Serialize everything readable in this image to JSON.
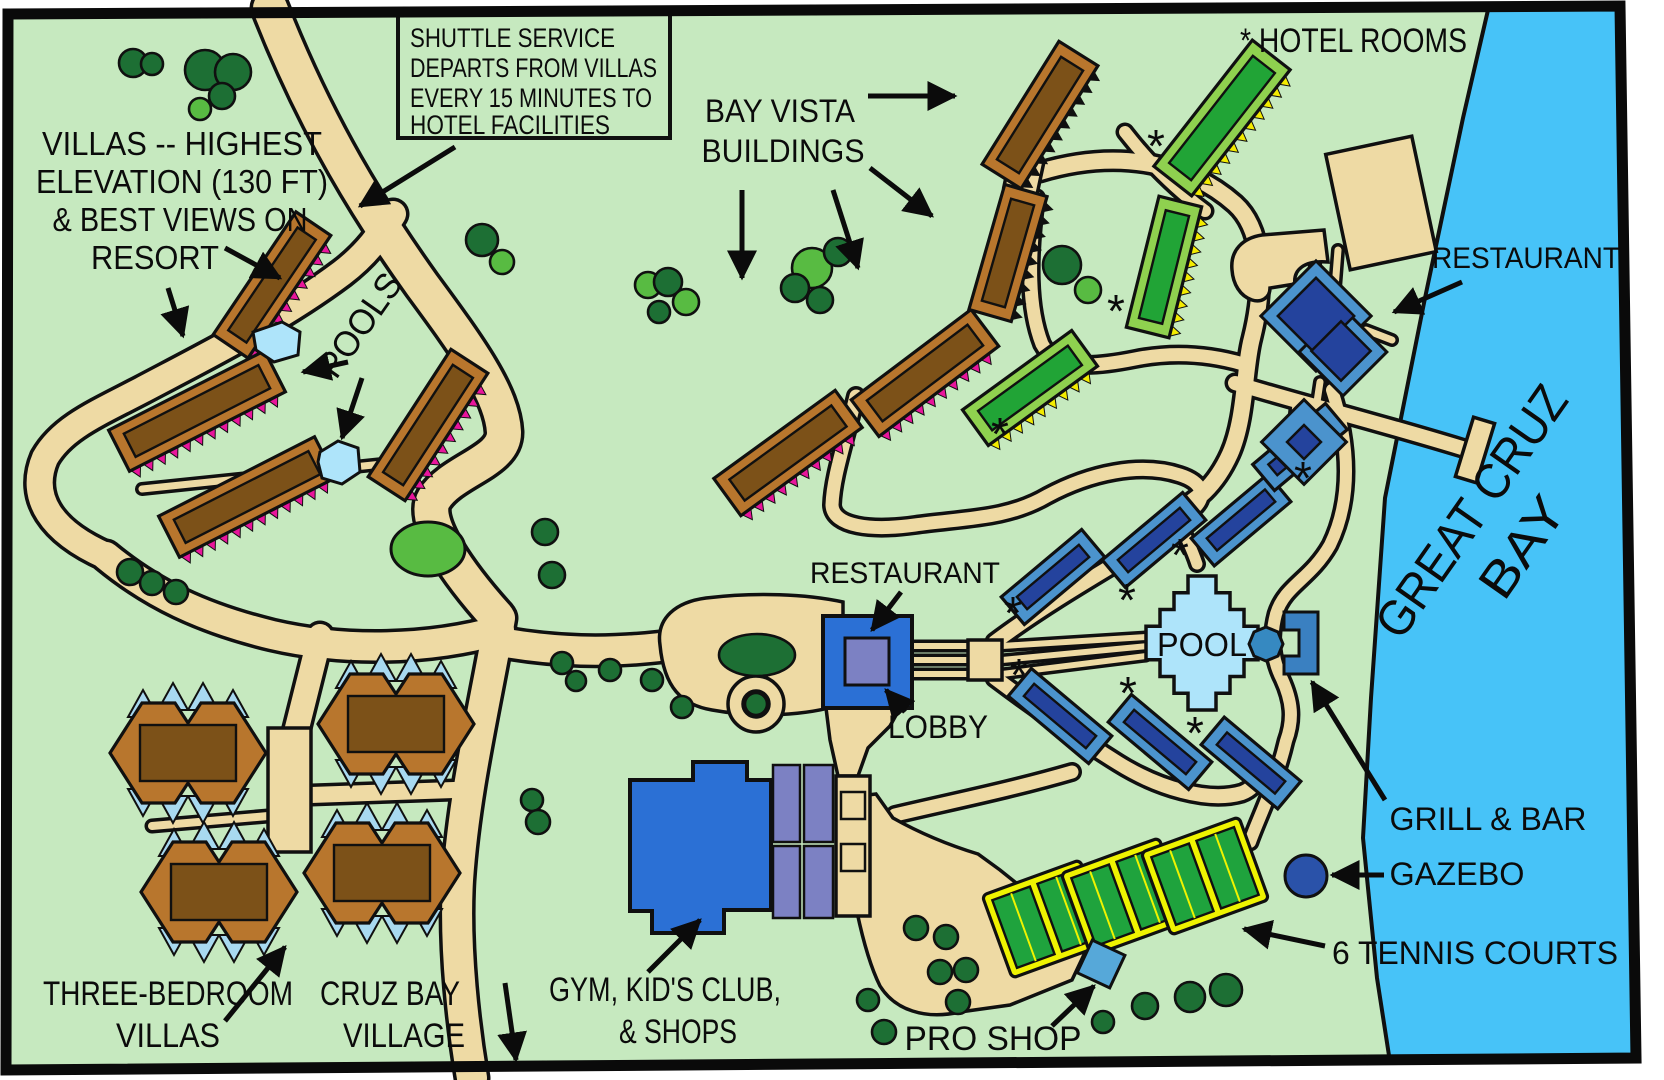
{
  "map_title": "Resort map of Great Cruz Bay",
  "labels": {
    "shuttle_note": {
      "line1": "SHUTTLE SERVICE",
      "line2": "DEPARTS FROM VILLAS",
      "line3": "EVERY 15 MINUTES TO",
      "line4": "HOTEL FACILITIES"
    },
    "villas_note": {
      "line1": "VILLAS -- HIGHEST",
      "line2": "ELEVATION (130 FT)",
      "line3": "& BEST VIEWS ON",
      "line4": "RESORT"
    },
    "bay_vista": {
      "line1": "BAY VISTA",
      "line2": "BUILDINGS"
    },
    "hotel_rooms": "* HOTEL ROOMS",
    "restaurant_top": "RESTAURANT",
    "pools": "POOLS",
    "restaurant_center": "RESTAURANT",
    "lobby": "LOBBY",
    "pool": "POOL",
    "grill_bar": "GRILL & BAR",
    "gazebo": "GAZEBO",
    "tennis_courts": "6 TENNIS COURTS",
    "pro_shop": "PRO SHOP",
    "gym": {
      "line1": "GYM,  KID'S CLUB,",
      "line2": "& SHOPS"
    },
    "cruz_bay": {
      "line1": "CRUZ BAY",
      "line2": "VILLAGE"
    },
    "three_bedroom": {
      "line1": "THREE-BEDROOM",
      "line2": "VILLAS"
    },
    "bay_name": {
      "line1": "GREAT CRUZ",
      "line2": "BAY"
    },
    "hotel_marker": "*"
  },
  "colors": {
    "land": "#c6e9bf",
    "water": "#47c3f8",
    "road": "#eedaa4",
    "outline": "#101010",
    "tree_dark": "#1d6f34",
    "tree_light": "#58bb42",
    "villa_outer": "#b8762d",
    "villa_inner": "#7c5118",
    "zig_magenta": "#e8159b",
    "green_outer": "#8fd14f",
    "green_inner": "#21a436",
    "zig_yellow": "#f3eb00",
    "blue_outer": "#4b93cd",
    "blue_inner": "#24439d",
    "bright_blue": "#2b70d5",
    "slate": "#7c81c3",
    "pool": "#aee4fa",
    "hot_tub": "#3689c1",
    "grill": "#3a80c1",
    "tennis_yellow": "#eff301",
    "tennis_green": "#1fa33d",
    "gazebo": "#2a52a9",
    "pro_shop": "#56a8d9"
  }
}
